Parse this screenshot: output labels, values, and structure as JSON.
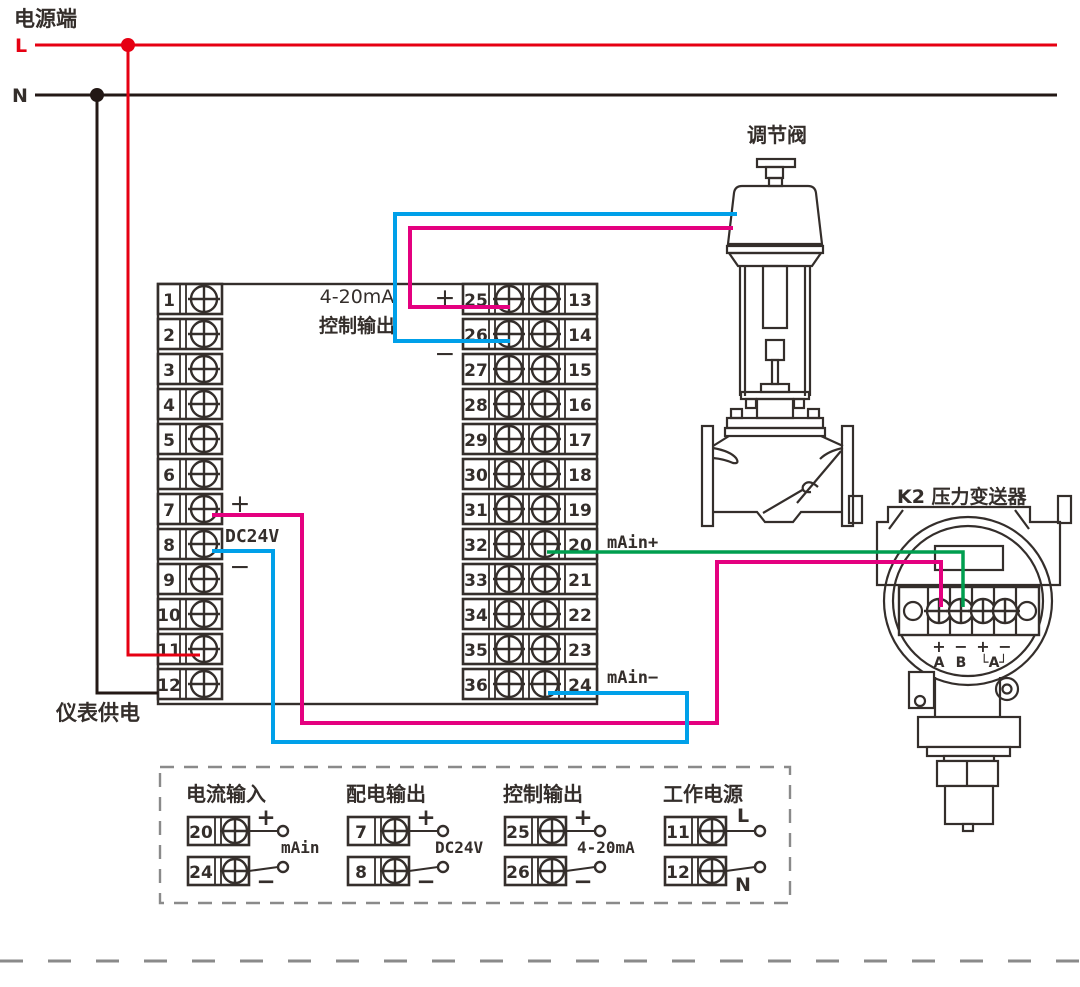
{
  "colors": {
    "red": "#e60012",
    "wire_black": "#231815",
    "pink": "#e4007f",
    "cyan": "#00a0e9",
    "green": "#009e4f",
    "ink": "#342e2b",
    "gray_dash": "#8a8a8a"
  },
  "power": {
    "title": "电源端",
    "line_l": "L",
    "line_n": "N"
  },
  "instrument": {
    "left_terminals": [
      "1",
      "2",
      "3",
      "4",
      "5",
      "6",
      "7",
      "8",
      "9",
      "10",
      "11",
      "12"
    ],
    "right_terminals_left": [
      "25",
      "26",
      "27",
      "28",
      "29",
      "30",
      "31",
      "32",
      "33",
      "34",
      "35",
      "36"
    ],
    "right_terminals_right": [
      "13",
      "14",
      "15",
      "16",
      "17",
      "18",
      "19",
      "20",
      "21",
      "22",
      "23",
      "24"
    ],
    "output_label_line1": "4-20mA",
    "output_label_line2": "控制输出",
    "output_plus": "+",
    "output_minus": "−",
    "dc24v_plus": "+",
    "dc24v_label": "DC24V",
    "dc24v_minus": "−",
    "main_plus": "mAin+",
    "main_minus": "mAin−",
    "supply_label": "仪表供电"
  },
  "valve": {
    "label": "调节阀"
  },
  "transmitter": {
    "label": "K2 压力变送器",
    "terminal_signs": [
      "+",
      "−",
      "+",
      "−"
    ],
    "terminal_names": [
      "A",
      "B",
      "└A┘"
    ]
  },
  "legend": {
    "sections": [
      {
        "title": "电流输入",
        "terminals": [
          "20",
          "24"
        ],
        "top_sign": "+",
        "bottom_sign": "−",
        "center_label": "mAin"
      },
      {
        "title": "配电输出",
        "terminals": [
          "7",
          "8"
        ],
        "top_sign": "+",
        "bottom_sign": "−",
        "center_label": "DC24V"
      },
      {
        "title": "控制输出",
        "terminals": [
          "25",
          "26"
        ],
        "top_sign": "+",
        "bottom_sign": "−",
        "center_label": "4-20mA"
      },
      {
        "title": "工作电源",
        "terminals": [
          "11",
          "12"
        ],
        "top_sign": "L",
        "bottom_sign": "N",
        "center_label": ""
      }
    ]
  }
}
